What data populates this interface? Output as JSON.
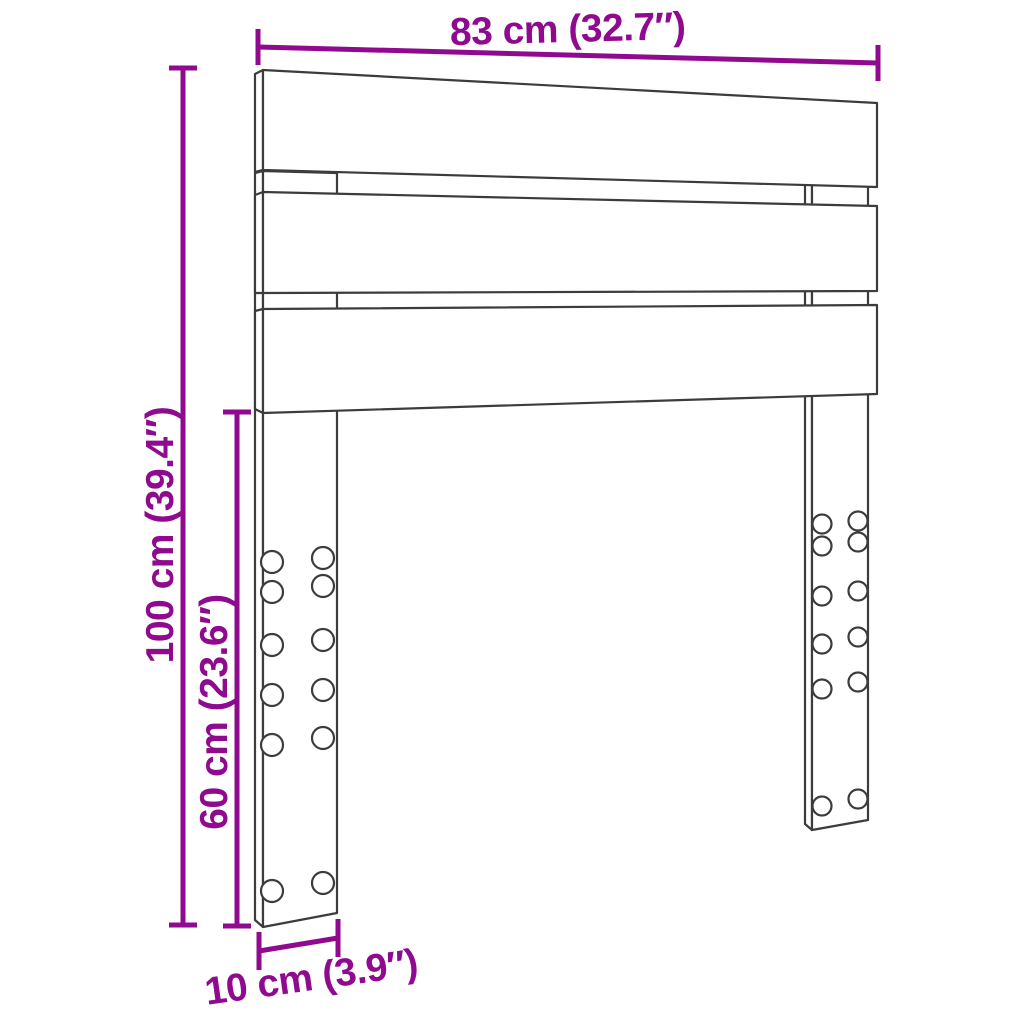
{
  "diagram": {
    "type": "product-dimension-diagram",
    "subject": "slatted headboard with two bolt-hole legs, drawn in light perspective",
    "colors": {
      "dimension_annotation": "#8F0A8F",
      "drawing_outline": "#3C3C3C",
      "background": "#FFFFFF"
    },
    "dimensions": {
      "width": {
        "label": "83 cm (32.7″)",
        "cm": "83",
        "inches": "32.7"
      },
      "height": {
        "label": "100 cm (39.4″)",
        "cm": "100",
        "inches": "39.4"
      },
      "leg_height": {
        "label": "60 cm (23.6″)",
        "cm": "60",
        "inches": "23.6"
      },
      "leg_width": {
        "label": "10 cm (3.9″)",
        "cm": "10",
        "inches": "3.9"
      }
    }
  }
}
